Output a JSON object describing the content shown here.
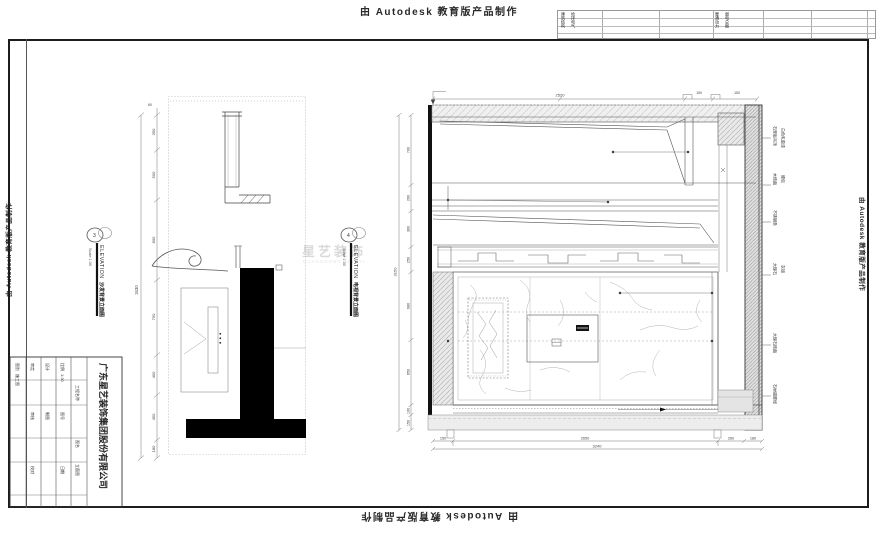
{
  "stamps": {
    "text": "由 Autodesk 教育版产品制作"
  },
  "signoff": {
    "block1_col1": "建筑结构",
    "block1_col2": "给排电气",
    "block2_col1": "暖通动力",
    "block2_col2": "弱电总图"
  },
  "elevation_labels": [
    {
      "bubble": "3",
      "title": "ELEVATION",
      "scale": "Scale 1:30",
      "caption": "沙发背景立面图"
    },
    {
      "bubble": "4",
      "title": "ELEVATION",
      "scale": "Scale 1:30",
      "caption": "电视背景立面图"
    }
  ],
  "title_block": {
    "company": "广东星艺装饰集团股份有限公司",
    "f1": "审定",
    "f2": "审核",
    "f3": "校对",
    "f4": "设计",
    "f5": "制图",
    "f6": "比例",
    "f7": "图号",
    "f8": "日期",
    "scale_value": "1:30",
    "project_label": "工程名称",
    "drawing_label": "图名",
    "drawing_name": "立面图",
    "note_label": "图别",
    "note_value": "施工图"
  },
  "left_elev": {
    "top_note": "60",
    "dims": [
      "350",
      "500",
      "800",
      "750",
      "400",
      "450",
      "180"
    ],
    "total": "3430"
  },
  "right_elev": {
    "top_dims": [
      "2520",
      "150",
      "150"
    ],
    "left_dims": [
      "700",
      "260",
      "360",
      "250",
      "680",
      "650",
      "100",
      "150"
    ],
    "left_total": "3150",
    "bottom_dims": [
      "150",
      "2650",
      "260",
      "180"
    ],
    "bottom_total": "3240",
    "materials": [
      {
        "a": "石膏板吊顶",
        "b": "白色乳胶漆"
      },
      {
        "a": "木饰面",
        "b": "硬包"
      },
      {
        "a": "不锈钢条",
        "b": ""
      },
      {
        "a": "大理石",
        "b": "灰镜"
      },
      {
        "a": "大理石饰面",
        "b": ""
      },
      {
        "a": "石材踢脚线",
        "b": ""
      }
    ]
  },
  "watermark": {
    "line1": "星艺装饰",
    "line2": "GUANGDONG XINGYI"
  }
}
